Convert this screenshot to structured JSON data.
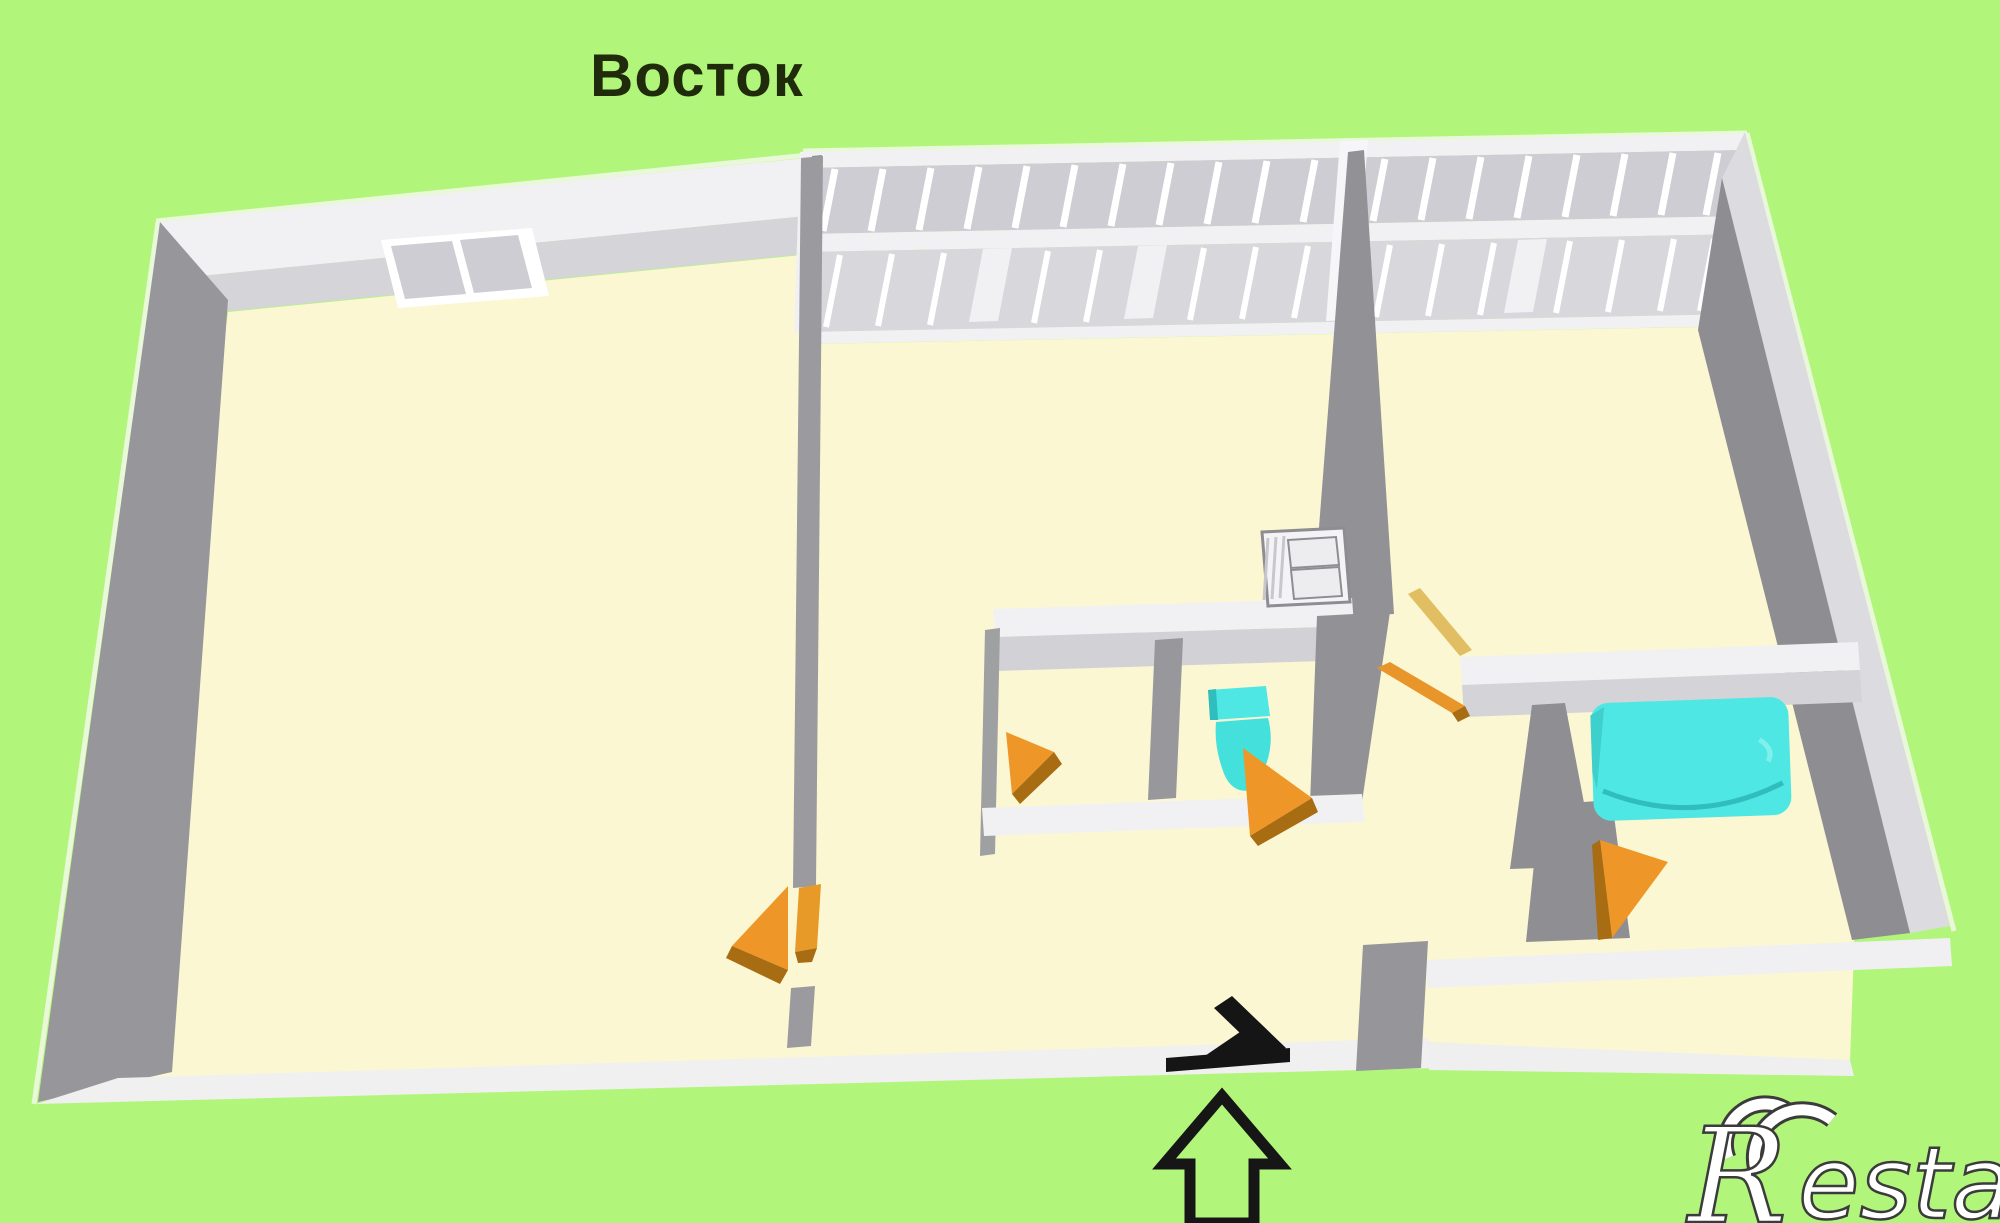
{
  "title": "Восток",
  "watermark": {
    "r": "R",
    "suffix": "estate"
  },
  "colors": {
    "background": "#B2F57B",
    "floor": "#FBF7D2",
    "wall_white": "#F1F1F3",
    "wall_light": "#D5D5D9",
    "wall_mid": "#A7A7AB",
    "wall_dark": "#909094",
    "window_pane": "#CDCDD3",
    "door_orange": "#EE9728",
    "door_orange_dark": "#A86C12",
    "fixture_cyan": "#4EE7E3",
    "entrance_black": "#151515",
    "title_text": "#1F2B0B",
    "logo_fill": "#FFFFFF",
    "logo_outline": "#3B3B3B"
  },
  "features": [
    "window-icon",
    "door-swing-icon",
    "bathtub-icon",
    "toilet-icon",
    "cabinet-icon",
    "entrance-door-icon",
    "up-arrow-icon"
  ]
}
